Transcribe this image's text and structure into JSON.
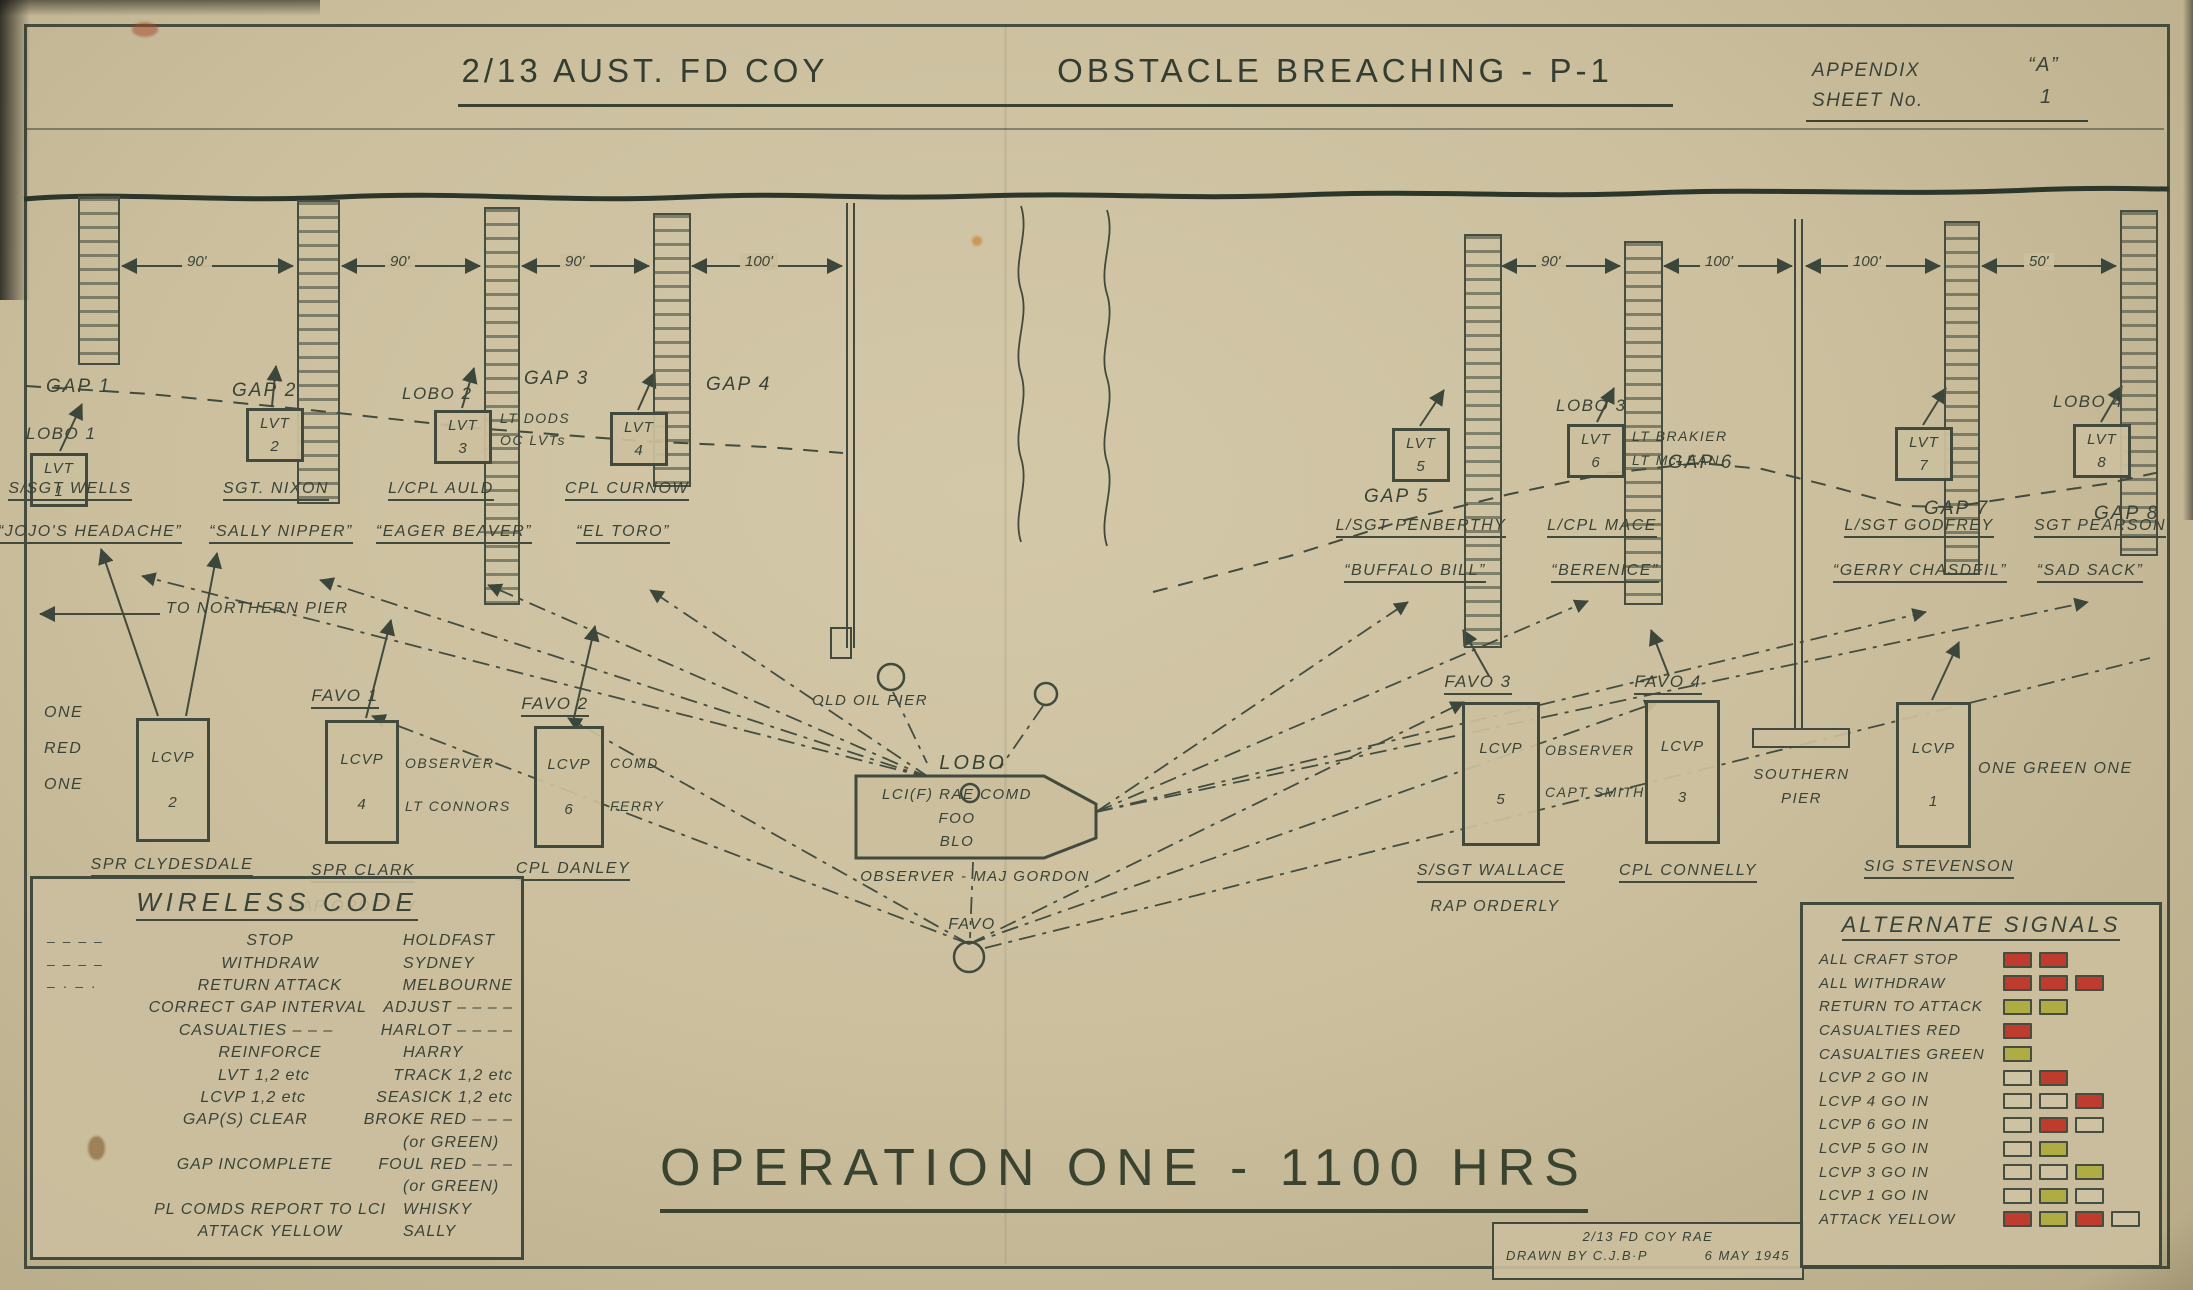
{
  "header": {
    "title_left": "2/13 AUST. FD COY",
    "title_right": "OBSTACLE BREACHING - P-1",
    "appendix_label": "APPENDIX",
    "appendix_value": "“A”",
    "sheet_label": "SHEET No.",
    "sheet_value": "1"
  },
  "shore": {
    "distances": [
      "90'",
      "90'",
      "90'",
      "100'",
      "90'",
      "100'",
      "100'",
      "50'"
    ],
    "gaps": [
      "GAP 1",
      "GAP 2",
      "GAP 3",
      "GAP 4",
      "GAP 5",
      "GAP 6",
      "GAP 7",
      "GAP 8"
    ]
  },
  "lvt": {
    "groups": [
      {
        "lobo": "LOBO 1",
        "unit": "LVT",
        "num": "1",
        "name": "S/SGT WELLS",
        "nick": "“JOJO'S HEADACHE”"
      },
      {
        "lobo": "",
        "unit": "LVT",
        "num": "2",
        "name": "SGT. NIXON",
        "nick": "“SALLY NIPPER”"
      },
      {
        "lobo": "LOBO 2",
        "unit": "LVT",
        "num": "3",
        "name": "L/CPL AULD",
        "nick": "“EAGER BEAVER”",
        "note1": "LT DODS",
        "note2": "OC LVTs"
      },
      {
        "lobo": "",
        "unit": "LVT",
        "num": "4",
        "name": "CPL CURNOW",
        "nick": "“EL TORO”"
      },
      {
        "lobo": "",
        "unit": "LVT",
        "num": "5",
        "name": "L/SGT PENBERTHY",
        "nick": "“BUFFALO BILL”"
      },
      {
        "lobo": "LOBO 3",
        "unit": "LVT",
        "num": "6",
        "name": "L/CPL MACE",
        "nick": "“BERENICE”",
        "note1": "LT BRAKIER",
        "note2": "LT McLEAN"
      },
      {
        "lobo": "",
        "unit": "LVT",
        "num": "7",
        "name": "L/SGT GODFREY",
        "nick": "“GERRY CHASDFIL”"
      },
      {
        "lobo": "LOBO 4",
        "unit": "LVT",
        "num": "8",
        "name": "SGT PEARSON",
        "nick": "“SAD SACK”"
      }
    ]
  },
  "lcvp": {
    "red_note": [
      "ONE",
      "RED",
      "ONE"
    ],
    "green_note": "ONE GREEN ONE",
    "groups": [
      {
        "favo": "",
        "unit": "LCVP",
        "num": "2",
        "side1": "",
        "side2": "",
        "name": "SPR CLYDESDALE",
        "extra": ""
      },
      {
        "favo": "FAVO 1",
        "unit": "LCVP",
        "num": "4",
        "side1": "OBSERVER",
        "side2": "LT CONNORS",
        "name": "SPR CLARK",
        "extra": "RAP ORDERLY"
      },
      {
        "favo": "FAVO 2",
        "unit": "LCVP",
        "num": "6",
        "side1": "COMD",
        "side2": "FERRY",
        "name": "CPL DANLEY",
        "extra": ""
      },
      {
        "favo": "FAVO 3",
        "unit": "LCVP",
        "num": "5",
        "side1": "OBSERVER",
        "side2": "CAPT SMITH",
        "name": "S/SGT WALLACE",
        "extra": "RAP ORDERLY"
      },
      {
        "favo": "FAVO 4",
        "unit": "LCVP",
        "num": "3",
        "side1": "",
        "side2": "",
        "name": "CPL CONNELLY",
        "extra": ""
      },
      {
        "favo": "",
        "unit": "LCVP",
        "num": "1",
        "side1": "",
        "side2": "",
        "name": "SIG STEVENSON",
        "extra": ""
      }
    ]
  },
  "center": {
    "old_pier": "OLD OIL PIER",
    "lobo_label": "LOBO",
    "boat_line1": "LCI(F) RAE COMD",
    "boat_line2": "FOO",
    "boat_line3": "BLO",
    "observer": "OBSERVER - MAJ GORDON",
    "southern1": "SOUTHERN",
    "southern2": "PIER",
    "northern": "TO NORTHERN PIER",
    "favo_point": "FAVO"
  },
  "wireless": {
    "title": "WIRELESS CODE",
    "rows": [
      {
        "pre": "– – – –",
        "term": "STOP",
        "code": "HOLDFAST"
      },
      {
        "pre": "– – – –",
        "term": "WITHDRAW",
        "code": "SYDNEY"
      },
      {
        "pre": "– · – ·",
        "term": "RETURN ATTACK",
        "code": "MELBOURNE"
      },
      {
        "pre": "",
        "term": "CORRECT GAP INTERVAL",
        "code": "ADJUST – – – –"
      },
      {
        "pre": "",
        "term": "CASUALTIES – – –",
        "code": "HARLOT – – – –"
      },
      {
        "pre": "",
        "term": "REINFORCE",
        "code": "HARRY"
      },
      {
        "pre": "",
        "term": "LVT 1,2 etc",
        "code": "TRACK 1,2 etc"
      },
      {
        "pre": "",
        "term": "LCVP 1,2 etc",
        "code": "SEASICK 1,2 etc"
      },
      {
        "pre": "",
        "term": "GAP(S) CLEAR",
        "code": "BROKE RED – – –"
      },
      {
        "pre": "",
        "term": "",
        "code": "(or GREEN)"
      },
      {
        "pre": "",
        "term": "GAP INCOMPLETE",
        "code": "FOUL RED – – –"
      },
      {
        "pre": "",
        "term": "",
        "code": "(or GREEN)"
      },
      {
        "pre": "",
        "term": "PL COMDS REPORT TO LCI",
        "code": "WHISKY"
      },
      {
        "pre": "",
        "term": "ATTACK YELLOW",
        "code": "SALLY"
      }
    ]
  },
  "signals": {
    "title": "ALTERNATE SIGNALS",
    "rows": [
      {
        "label": "ALL CRAFT STOP",
        "flags": [
          "red",
          "red"
        ]
      },
      {
        "label": "ALL WITHDRAW",
        "flags": [
          "red",
          "red",
          "red"
        ]
      },
      {
        "label": "RETURN TO ATTACK",
        "flags": [
          "yellow",
          "yellow"
        ]
      },
      {
        "label": "CASUALTIES RED",
        "flags": [
          "red"
        ]
      },
      {
        "label": "CASUALTIES GREEN",
        "flags": [
          "yellow"
        ]
      },
      {
        "label": "LCVP 2 GO IN",
        "flags": [
          "white",
          "red"
        ]
      },
      {
        "label": "LCVP 4 GO IN",
        "flags": [
          "white",
          "white",
          "red"
        ]
      },
      {
        "label": "LCVP 6 GO IN",
        "flags": [
          "white",
          "red",
          "white"
        ]
      },
      {
        "label": "LCVP 5 GO IN",
        "flags": [
          "white",
          "yellow"
        ]
      },
      {
        "label": "LCVP 3 GO IN",
        "flags": [
          "white",
          "white",
          "yellow"
        ]
      },
      {
        "label": "LCVP 1 GO IN",
        "flags": [
          "white",
          "yellow",
          "white"
        ]
      },
      {
        "label": "ATTACK YELLOW",
        "flags": [
          "red",
          "yellow",
          "red",
          "white"
        ]
      }
    ]
  },
  "operation": {
    "title": "OPERATION ONE - 1100 HRS"
  },
  "credit": {
    "line1": "2/13 FD COY RAE",
    "line2": "DRAWN BY C.J.B·P",
    "date": "6 MAY 1945"
  },
  "colors": {
    "ink": "#3a4337",
    "paper": "#cbbf9e",
    "red": "#bf3b2d",
    "yellow": "#aeac42"
  }
}
